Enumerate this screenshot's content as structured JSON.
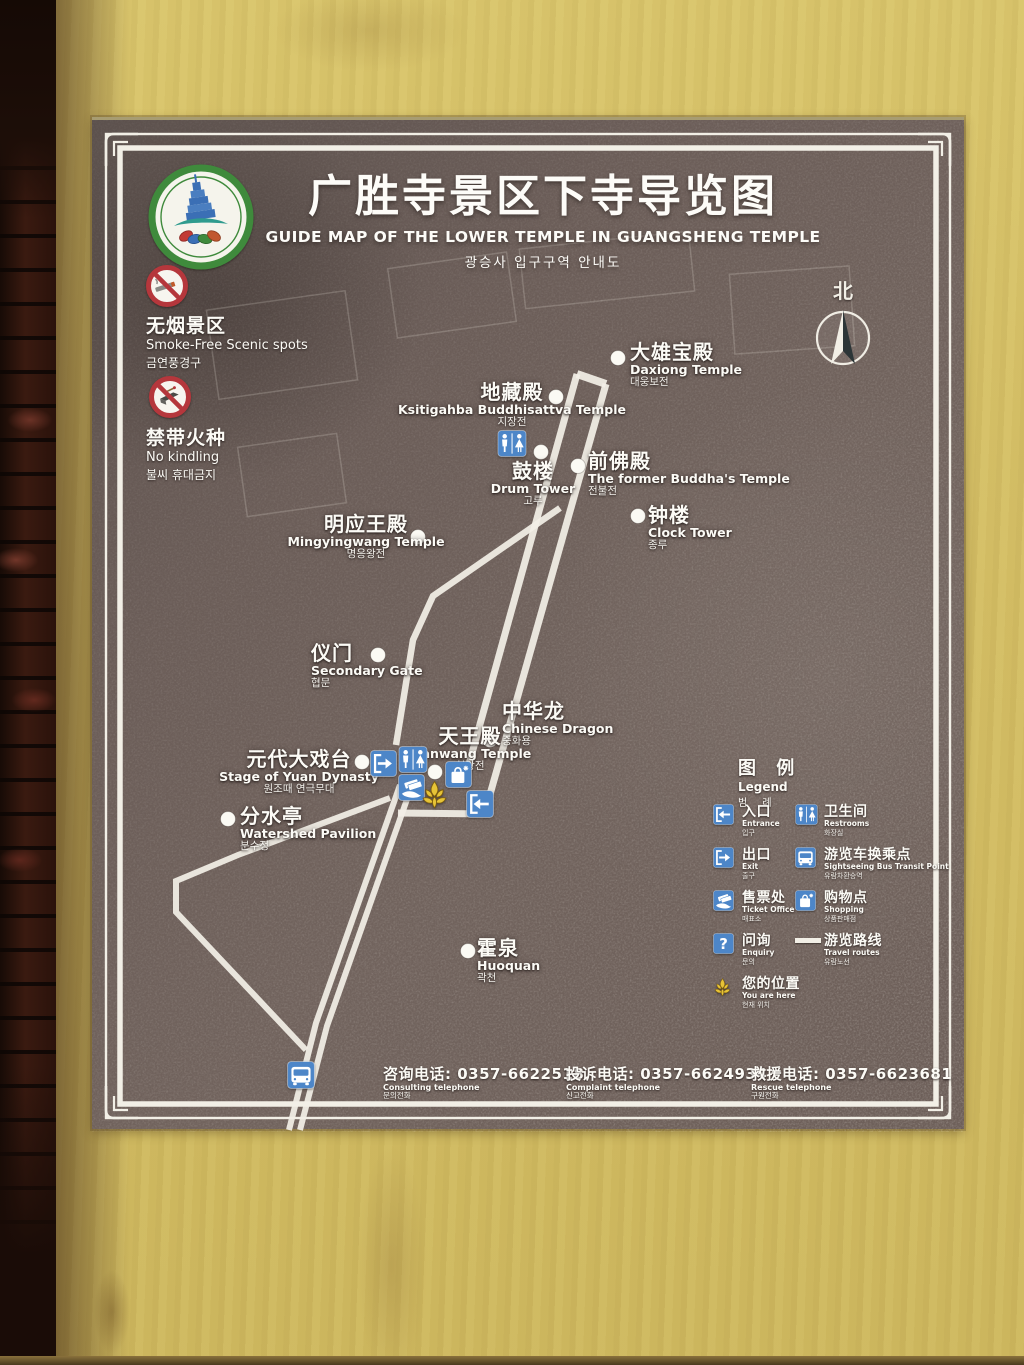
{
  "photo": {
    "wall_color": "#d3bd63",
    "brick_color": "#3a1b12",
    "panel_color": "#6b5d58",
    "route_color": "#f2efe6",
    "icon_blue": "#4d86c8",
    "marker_gold": "#e6c337",
    "prohibition_red": "#b5373c",
    "logo_green": "#3f8a3c"
  },
  "sign": {
    "logo": {
      "icon": "scenic-area-emblem"
    },
    "title_zh": "广胜寺景区下寺导览图",
    "title_en": "GUIDE MAP OF THE LOWER TEMPLE IN GUANGSHENG TEMPLE",
    "title_ko": "광승사 입구구역 안내도",
    "compass": {
      "label": "北",
      "icon": "north-compass-icon"
    },
    "notices": [
      {
        "icon": "no-smoking-icon",
        "zh": "无烟景区",
        "en": "Smoke-Free Scenic spots",
        "ko": "금연풍경구"
      },
      {
        "icon": "no-kindling-icon",
        "zh": "禁带火种",
        "en": "No kindling",
        "ko": "불씨 휴대금지"
      }
    ],
    "locations": [
      {
        "id": "daxiong-temple",
        "zh": "大雄宝殿",
        "en": "Daxiong Temple",
        "ko": "대웅보전",
        "x": 526,
        "y": 238
      },
      {
        "id": "ksitigahba-temple",
        "zh": "地藏殿",
        "en": "Ksitigahba Buddhisattva Temple",
        "ko": "지장전",
        "x": 464,
        "y": 277
      },
      {
        "id": "drum-tower",
        "zh": "鼓楼",
        "en": "Drum Tower",
        "ko": "고루",
        "x": 449,
        "y": 332
      },
      {
        "id": "former-buddha-temple",
        "zh": "前佛殿",
        "en": "The former Buddha's Temple",
        "ko": "전불전",
        "x": 486,
        "y": 346
      },
      {
        "id": "clock-tower",
        "zh": "钟楼",
        "en": "Clock Tower",
        "ko": "종루",
        "x": 546,
        "y": 396
      },
      {
        "id": "mingyingwang-temple",
        "zh": "明应王殿",
        "en": "Mingyingwang Temple",
        "ko": "명응왕전",
        "x": 326,
        "y": 417
      },
      {
        "id": "secondary-gate",
        "zh": "仪门",
        "en": "Secondary Gate",
        "ko": "협문",
        "x": 286,
        "y": 535
      },
      {
        "id": "chinese-dragon",
        "zh": "中华龙",
        "en": "Chinese Dragon",
        "ko": "중화용",
        "x": 398,
        "y": 620
      },
      {
        "id": "tianwang-temple",
        "zh": "天王殿",
        "en": "Tianwang Temple",
        "ko": "천왕전",
        "x": 343,
        "y": 652
      },
      {
        "id": "yuan-dynasty-stage",
        "zh": "元代大戏台",
        "en": "Stage of Yuan Dynasty",
        "ko": "원조때 연극무대",
        "x": 270,
        "y": 642
      },
      {
        "id": "watershed-pavilion",
        "zh": "分水亭",
        "en": "Watershed Pavilion",
        "ko": "분수정",
        "x": 136,
        "y": 699
      },
      {
        "id": "huoquan-spring",
        "zh": "霍泉",
        "en": "Huoquan",
        "ko": "곽천",
        "x": 376,
        "y": 831
      }
    ],
    "legend": {
      "title_zh": "图 例",
      "title_en": "Legend",
      "title_ko": "범  례",
      "items": [
        {
          "icon": "entrance-icon",
          "zh": "入口",
          "en": "Entrance",
          "ko": "입구"
        },
        {
          "icon": "restroom-icon",
          "zh": "卫生间",
          "en": "Restrooms",
          "ko": "화장실"
        },
        {
          "icon": "exit-icon",
          "zh": "出口",
          "en": "Exit",
          "ko": "출구"
        },
        {
          "icon": "bus-icon",
          "zh": "游览车换乘点",
          "en": "Sightseeing Bus Transit Point",
          "ko": "유람차환승역"
        },
        {
          "icon": "ticket-office-icon",
          "zh": "售票处",
          "en": "Ticket Office",
          "ko": "매표소"
        },
        {
          "icon": "shopping-icon",
          "zh": "购物点",
          "en": "Shopping",
          "ko": "상품판매점"
        },
        {
          "icon": "enquiry-icon",
          "zh": "问询",
          "en": "Enquiry",
          "ko": "문의"
        },
        {
          "icon": "route-line-icon",
          "zh": "游览路线",
          "en": "Travel routes",
          "ko": "유람노선"
        },
        {
          "icon": "you-are-here-icon",
          "zh": "您的位置",
          "en": "You are here",
          "ko": "현재 위치"
        }
      ]
    },
    "phones": [
      {
        "zh": "咨询电话:",
        "number": "0357-6622518",
        "en": "Consulting telephone",
        "ko": "문의전화"
      },
      {
        "zh": "投诉电话:",
        "number": "0357-6624934",
        "en": "Complaint telephone",
        "ko": "신고전화"
      },
      {
        "zh": "救援电话:",
        "number": "0357-6623681",
        "en": "Rescue telephone",
        "ko": "구원전화"
      }
    ]
  }
}
